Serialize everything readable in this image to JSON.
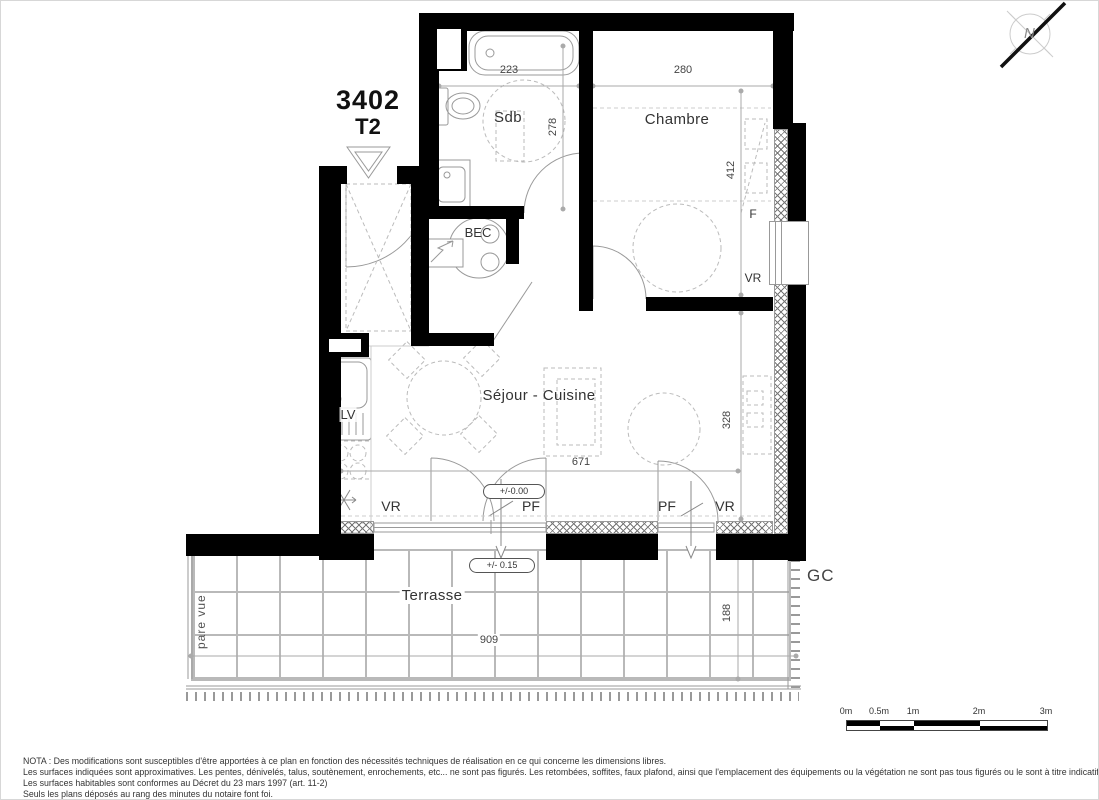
{
  "header": {
    "unit_number": "3402",
    "unit_type": "T2"
  },
  "rooms": {
    "bathroom": "Sdb",
    "bedroom": "Chambre",
    "living_kitchen": "Séjour - Cuisine",
    "terrace": "Terrasse"
  },
  "equipment": {
    "water_heater": "BEC",
    "dishwasher": "LV"
  },
  "openings": {
    "roller_shutter": "VR",
    "french_door": "PF",
    "window": "F"
  },
  "dimensions": {
    "bathroom_width": "223",
    "bathroom_depth": "278",
    "bedroom_width": "280",
    "bedroom_depth": "412",
    "living_width": "671",
    "living_depth": "328",
    "terrace_width": "909",
    "terrace_depth": "188"
  },
  "levels": {
    "interior": "+/-0.00",
    "terrace": "+/- 0.15"
  },
  "annotations": {
    "gc": "GC",
    "privacy_screen": "pare vue",
    "north": "N"
  },
  "scale_bar": {
    "labels": [
      "0m",
      "0.5m",
      "1m",
      "2m",
      "3m"
    ]
  },
  "notes": {
    "line1": "NOTA : Des modifications sont susceptibles d'être apportées à ce plan en fonction des nécessités techniques de réalisation en ce qui concerne les dimensions libres.",
    "line2": "Les surfaces indiquées sont approximatives. Les pentes, dénivelés, talus, soutènement, enrochements, etc... ne sont pas figurés. Les retombées, soffites, faux plafond, ainsi que l'emplacement des équipements ou la végétation ne sont pas tous figurés ou le sont à titre indicatif.",
    "line3": "Les surfaces habitables sont conformes au Décret du 23 mars 1997 (art. 11-2)",
    "line4": "Seuls les plans déposés au rang des minutes du notaire font foi."
  }
}
